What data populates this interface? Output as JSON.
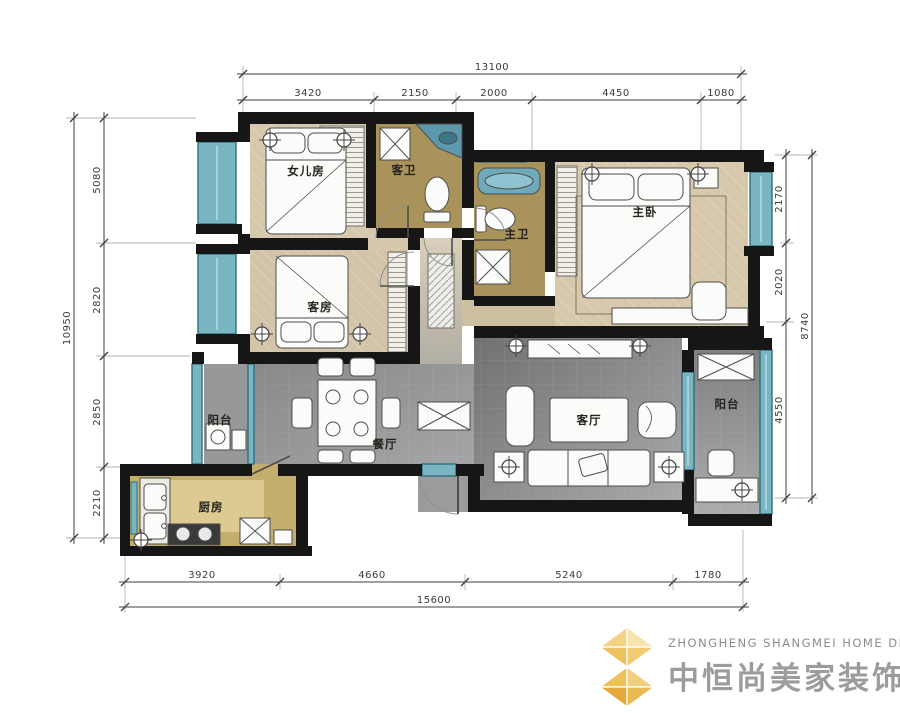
{
  "rooms": {
    "daughter": "女儿房",
    "guest_bath": "客卫",
    "master_bath": "主卫",
    "master": "主卧",
    "guest": "客房",
    "balcony_left": "阳台",
    "dining": "餐厅",
    "living": "客厅",
    "balcony_right": "阳台",
    "kitchen": "厨房"
  },
  "dims": {
    "top": {
      "total": "13100",
      "segments": [
        "3420",
        "2150",
        "2000",
        "4450",
        "1080"
      ]
    },
    "bottom": {
      "total": "15600",
      "segments": [
        "3920",
        "4660",
        "5240",
        "1780"
      ]
    },
    "left": {
      "total": "10950",
      "segments": [
        "5080",
        "2820",
        "2850",
        "2210"
      ]
    },
    "right": {
      "total": "8740",
      "segments": [
        "2170",
        "2020",
        "4550"
      ]
    }
  },
  "logo": {
    "en": "ZHONGHENG SHANGMEI HOME DECORATION",
    "zh": "中恒尚美家装饰"
  },
  "colors": {
    "wall": "#161616",
    "window_teal": "#7ab5c2",
    "floor_wood": "#d6c8ad",
    "floor_bath": "#a9935a",
    "floor_gray": "#8c8d8f",
    "floor_kitchen": "#c4ae6e",
    "dim_line": "#3f3f3f",
    "logo_gold": "#eec05a",
    "logo_text_gray": "#8b8b8b"
  }
}
